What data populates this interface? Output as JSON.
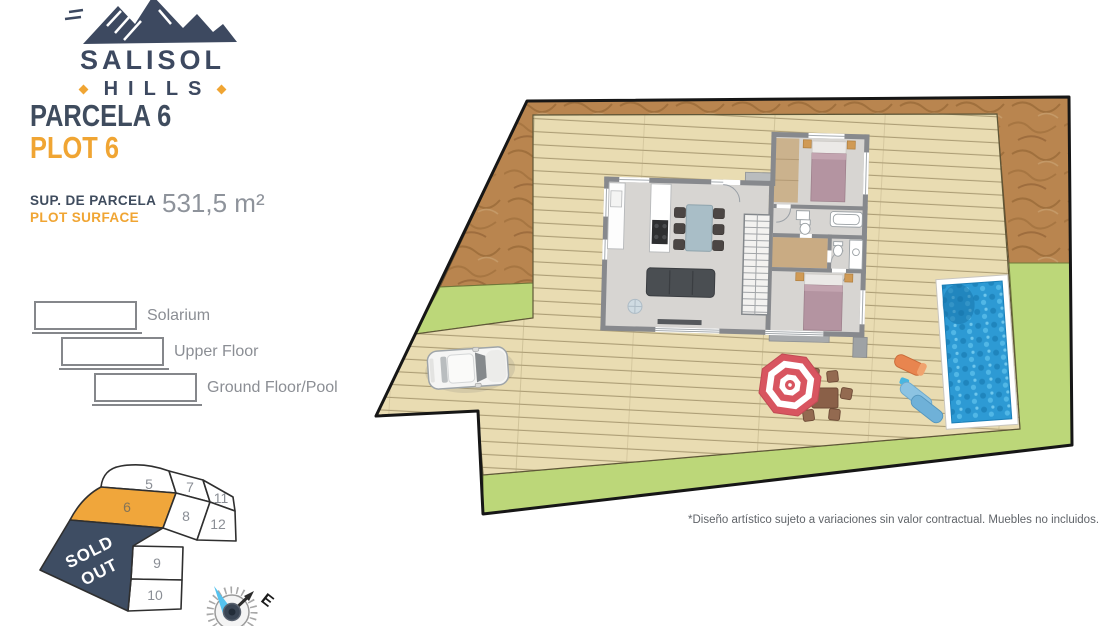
{
  "brand": {
    "name": "SALISOL",
    "sub": "HILLS"
  },
  "header": {
    "parcela": "PARCELA 6",
    "plot": "PLOT 6",
    "surface_label_primary": "SUP. DE PARCELA",
    "surface_label_secondary": "PLOT SURFACE",
    "surface_value": "531,5 m²"
  },
  "legend": {
    "items": [
      {
        "label": "Solarium"
      },
      {
        "label": "Upper Floor"
      },
      {
        "label": "Ground Floor/Pool"
      }
    ]
  },
  "plot_map": {
    "numbers": {
      "n5": "5",
      "n6": "6",
      "n7": "7",
      "n8": "8",
      "n9": "9",
      "n10": "10",
      "n11": "11",
      "n12": "12"
    },
    "sold_out_line1": "SOLD",
    "sold_out_line2": "OUT",
    "highlighted_plot": "6"
  },
  "compass": {
    "east_label": "E"
  },
  "site_plan": {
    "disclaimer": "*Diseño artístico sujeto a variaciones sin valor contractual. Muebles no incluidos."
  },
  "colors": {
    "navy": "#3d4960",
    "orange": "#f0a533",
    "sold_out_navy": "#3e4d63",
    "highlight_orange": "#f0a63b",
    "deck_wood": "#e9dcb2",
    "terrain_brown": "#b9854f",
    "grass_green": "#bcd779",
    "pool_blue": "#2d9ad4"
  }
}
